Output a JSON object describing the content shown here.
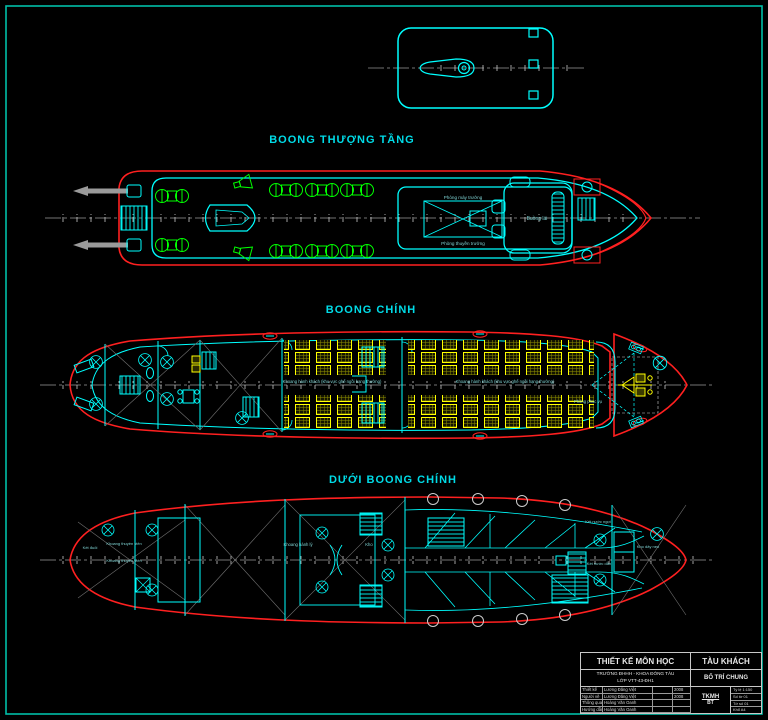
{
  "titles": {
    "upper_deck": "BOONG THƯỢNG TẦNG",
    "main_deck": "BOONG CHÍNH",
    "lower_deck": "DƯỚI BOONG CHÍNH"
  },
  "upper_labels": {
    "chief_engineer_room": "Phòng máy trưởng",
    "captain_room": "Phòng thuyền trưởng",
    "wheelhouse": "Buồng lái"
  },
  "main_labels": {
    "passenger_aft": "Khoang hành khách (khu vực ghế ngồi hạng thường)",
    "passenger_fwd": "Khoang hành khách (khu vực ghế ngồi hạng thường)",
    "service_room": "Phòng phục vụ"
  },
  "lower_labels": {
    "aft_peak": "Két đuôi",
    "crew_1": "Khoang thuyền viên",
    "crew_2": "Khoang thuyền viên",
    "luggage": "Khoang hành lý",
    "store": "Kho",
    "fresh_water": "Két nước ngọt",
    "ballast": "Két nước dằn",
    "chain_locker": "Kho dây neo"
  },
  "title_block": {
    "project": "THIẾT KẾ MÔN HỌC",
    "vessel": "TÀU KHÁCH",
    "org_line1": "TRƯỜNG ĐHHH - KHOA ĐÓNG TÀU",
    "org_line2": "LỚP VTT-43-ĐH1",
    "drawing_title": "BỐ TRÍ CHUNG",
    "doc_code": "TKMH",
    "doc_sub": "BT",
    "rows": [
      {
        "role": "Thiết kế",
        "name": "Lương Đăng Việt",
        "sign": "",
        "year": "2008"
      },
      {
        "role": "Người vẽ",
        "name": "Lương Đăng Việt",
        "sign": "",
        "year": "2008"
      },
      {
        "role": "Thông qua",
        "name": "Hoàng Văn Oanh",
        "sign": "",
        "year": ""
      },
      {
        "role": "Hướng dẫn",
        "name": "Hoàng Văn Oanh",
        "sign": "",
        "year": ""
      }
    ],
    "meta": [
      "Tỷ lệ 1:150",
      "Số tờ 01",
      "Tờ số 01",
      "Khổ A4"
    ]
  },
  "colors": {
    "background": "#000000",
    "sheet_border": "#00bfa8",
    "hull": "#ff2020",
    "structure": "#00ffff",
    "furniture": "#00ff00",
    "seats": "#ffff00",
    "centerline": "#9a9a9a",
    "title_text": "#00dce8"
  }
}
